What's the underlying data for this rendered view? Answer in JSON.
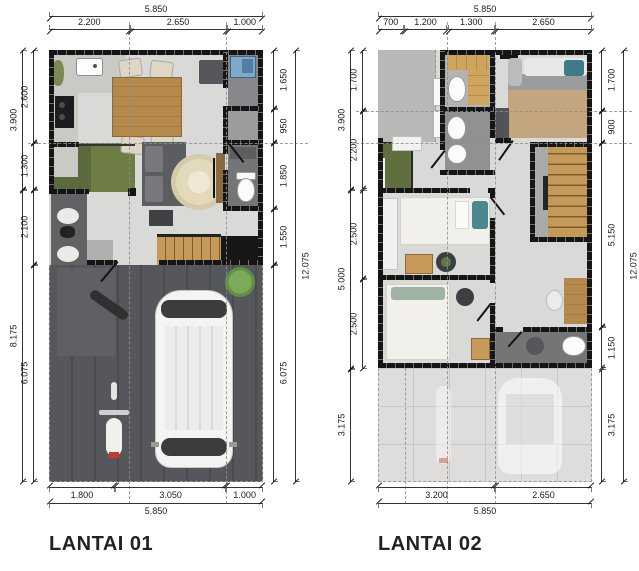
{
  "plans": [
    {
      "title": "LANTAI 01",
      "dims": {
        "top_total": "5.850",
        "top_segments": [
          "2.200",
          "2.650",
          "1.000"
        ],
        "left_outer": [
          "3.900",
          "8.175"
        ],
        "left_inner": [
          "2.600",
          "1.300",
          "2.100",
          "6.075"
        ],
        "right_inner": [
          "1.650",
          "950",
          "1.850",
          "1.550",
          "6.075"
        ],
        "right_outer": "12.075",
        "bottom_segments": [
          "1.800",
          "3.050",
          "1.000"
        ],
        "bottom_total": "5.850"
      }
    },
    {
      "title": "LANTAI 02",
      "dims": {
        "top_total": "5.850",
        "top_segments": [
          "700",
          "1.200",
          "1.300",
          "2.650"
        ],
        "left_outer": [
          "3.900",
          "5.000",
          "3.175"
        ],
        "left_inner": [
          "1.700",
          "2.200",
          "2.500",
          "2.500"
        ],
        "right_inner": [
          "1.700",
          "900",
          "5.150",
          "1.150",
          "3.175"
        ],
        "right_outer": "12.075",
        "bottom_segments": [
          "3.200",
          "2.650"
        ],
        "bottom_total": "5.850"
      }
    }
  ],
  "colors": {
    "wall": "#151515",
    "floor": "#d9d9d7",
    "wood_table": "#b5894c",
    "stair_wood": "#c59a58",
    "garden_green": "#5f6f3e",
    "driveway": "#55575a",
    "washer_blue": "#7fa9c9",
    "accent_teal": "#4a8891",
    "tail_red": "#c23b2e"
  }
}
